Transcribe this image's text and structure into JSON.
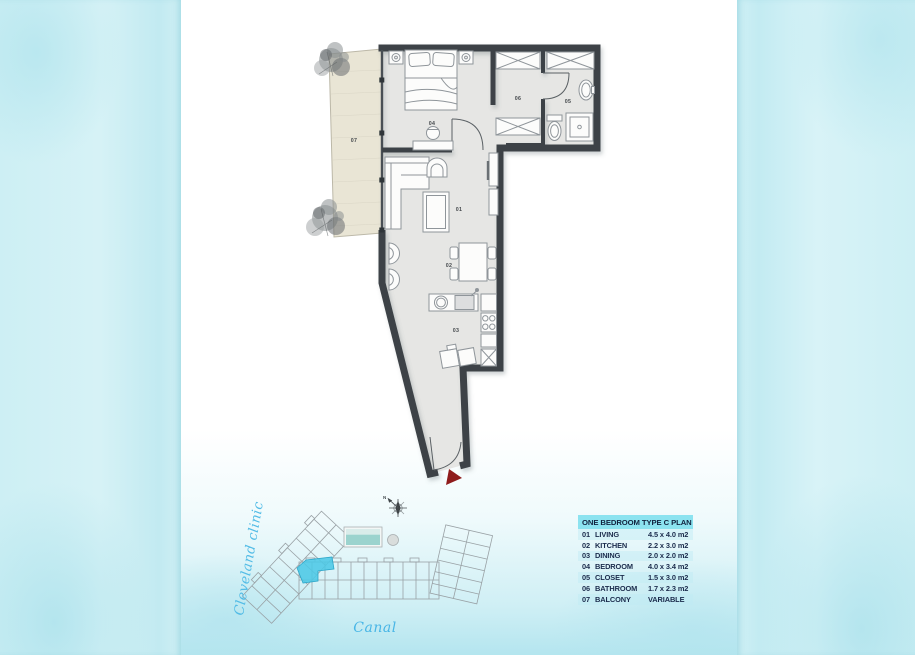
{
  "legend": {
    "header": "ONE BEDROOM TYPE C PLAN",
    "rows": [
      {
        "id": "01",
        "name": "LIVING",
        "dim": "4.5 x 4.0 m2"
      },
      {
        "id": "02",
        "name": "KITCHEN",
        "dim": "2.2 x 3.0 m2"
      },
      {
        "id": "03",
        "name": "DINING",
        "dim": "2.0 x 2.0 m2"
      },
      {
        "id": "04",
        "name": "BEDROOM",
        "dim": "4.0 x 3.4 m2"
      },
      {
        "id": "05",
        "name": "CLOSET",
        "dim": "1.5 x 3.0 m2"
      },
      {
        "id": "06",
        "name": "BATHROOM",
        "dim": "1.7 x 2.3 m2"
      },
      {
        "id": "07",
        "name": "BALCONY",
        "dim": "VARIABLE"
      }
    ]
  },
  "plan": {
    "room_labels": {
      "living": "01",
      "dining": "02",
      "kitchen": "03",
      "bedroom": "04",
      "bath": "05",
      "closet": "06",
      "balcony": "07"
    }
  },
  "site": {
    "left_label": "Cleveland clinic",
    "bottom_label": "Canal",
    "compass_letter": "N"
  },
  "colors": {
    "wall": "#3d4347",
    "floor": "#e6e6e4",
    "balcony_floor": "#e9e5d5",
    "legend_header_bg": "#8ce3f0",
    "legend_text": "#1b2b4c",
    "highlight_unit": "#4cc8e6",
    "water_text": "#4cb9e5",
    "entrance_marker": "#8f1c1c",
    "background_wash": "#cdeff4"
  }
}
